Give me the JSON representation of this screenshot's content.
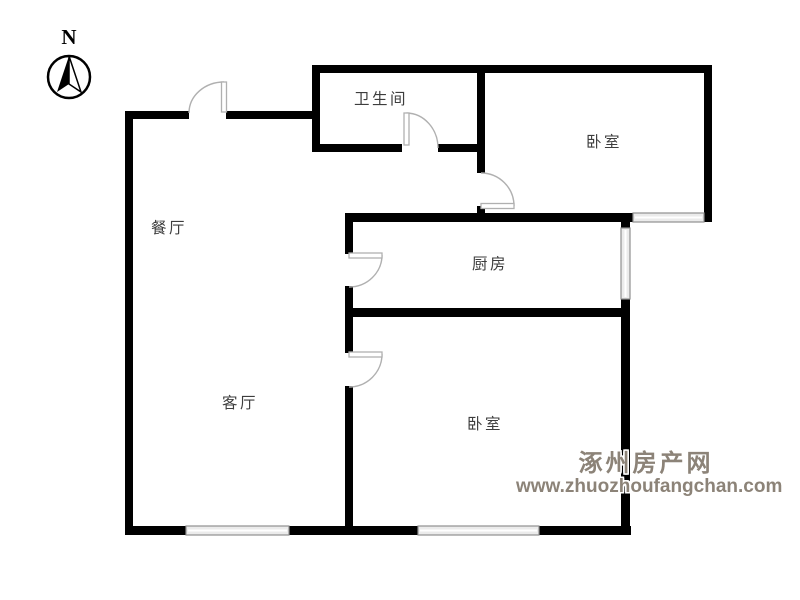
{
  "compass": {
    "north_label": "N"
  },
  "rooms": {
    "bathroom": "卫生间",
    "bedroom_top": "卧室",
    "dining": "餐厅",
    "kitchen": "厨房",
    "living": "客厅",
    "bedroom_bottom": "卧室"
  },
  "watermark": {
    "site_name": "涿州房产网",
    "site_url": "www.zhuozhoufangchan.com"
  },
  "colors": {
    "wall": "#000000",
    "door_arc": "#b0b0b0",
    "window_frame": "#8f8f8f",
    "window_fill": "#ebebeb",
    "room_label": "#3d3d3d",
    "watermark_text": "#8c8378",
    "background": "#ffffff"
  }
}
